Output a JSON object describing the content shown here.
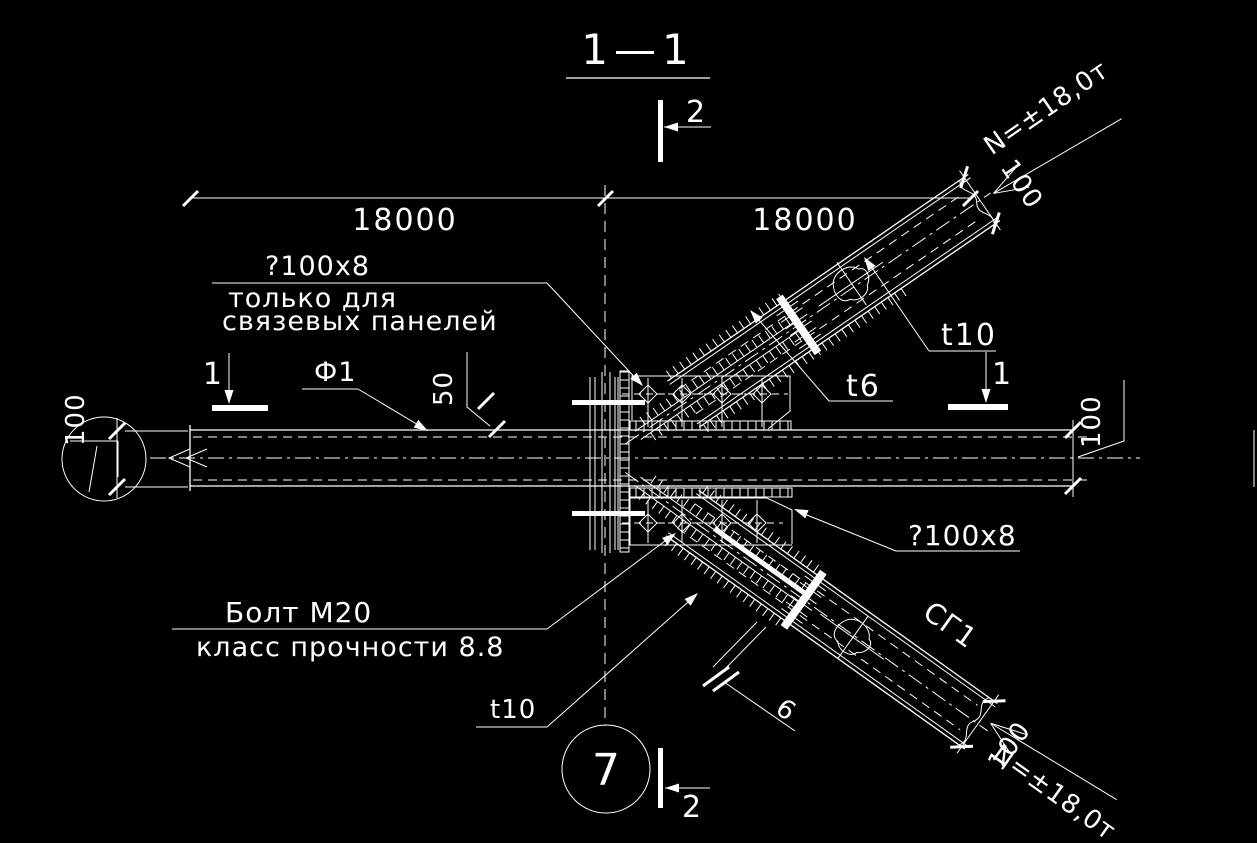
{
  "drawing": {
    "title": "1—1",
    "section_marks": {
      "mark_2": "2",
      "mark_1": "1"
    },
    "grid_axis": {
      "number": "7"
    },
    "dimensions": {
      "span_left": "18000",
      "span_right": "18000",
      "plate_offset": "50",
      "member_width": "100",
      "brace_end_offset": "100"
    },
    "notes": {
      "plate_note_line1": "?100x8",
      "plate_note_line2": "только для",
      "plate_note_line3": "связевых панелей",
      "plate_note_lower": "?100x8",
      "bolt_note_line1": "Болт М20",
      "bolt_note_line2": "класс прочности 8.8",
      "weld_count": "6"
    },
    "marks": {
      "beam_mark": "Ф1",
      "brace_mark": "СГ1"
    },
    "thicknesses": {
      "t6": "t6",
      "t10": "t10"
    },
    "forces": {
      "upper": "N=±18,0т",
      "lower": "N=±18,0т"
    },
    "colors": {
      "background": "#000000",
      "line": "#ffffff"
    }
  }
}
